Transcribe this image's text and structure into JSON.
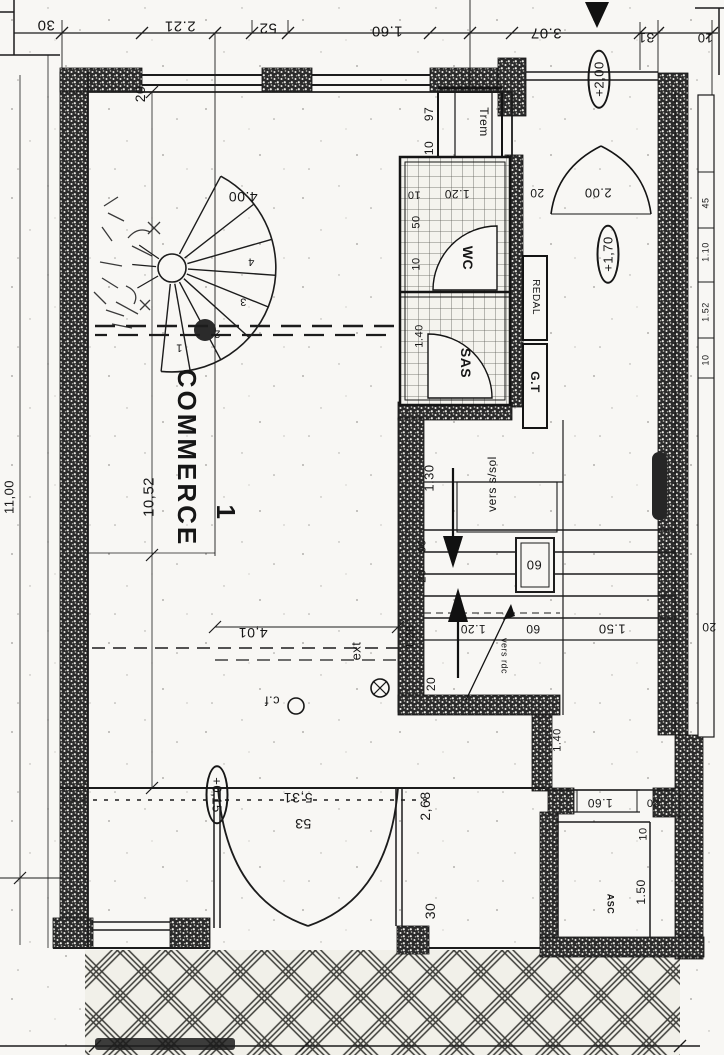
{
  "style": {
    "ink": "#1c1c1c",
    "paper": "#f8f7f4",
    "wall_hatch": "speckled-black",
    "floor_hatch": "tile-grid",
    "pavement_hatch": "diamond-lattice"
  },
  "drawing": {
    "type": "scanned-floor-plan",
    "main_room": "COMMERCE 1",
    "rooms": [
      "COMMERCE 1",
      "WC",
      "SAS",
      "ASC"
    ],
    "elevations": [
      "+2,00",
      "+1,70",
      "+0,15"
    ]
  },
  "annotations": [
    {
      "name": "dim-30-top",
      "text": "30",
      "x": 46,
      "y": 25,
      "rot": 180,
      "size": 15
    },
    {
      "name": "dim-221-top",
      "text": "2.21",
      "x": 180,
      "y": 26,
      "rot": 180,
      "size": 15
    },
    {
      "name": "dim-52-top",
      "text": "52",
      "x": 268,
      "y": 28,
      "rot": 180,
      "size": 15
    },
    {
      "name": "dim-160-top",
      "text": "1.60",
      "x": 387,
      "y": 31,
      "rot": 180,
      "size": 15
    },
    {
      "name": "dim-307-top",
      "text": "3.07",
      "x": 546,
      "y": 33,
      "rot": 180,
      "size": 15
    },
    {
      "name": "dim-31-top",
      "text": "31",
      "x": 646,
      "y": 38,
      "rot": 180,
      "size": 14
    },
    {
      "name": "dim-10-top-right",
      "text": "10",
      "x": 705,
      "y": 38,
      "rot": 180,
      "size": 13
    },
    {
      "name": "dim-1100-left",
      "text": "11,00",
      "x": 9,
      "y": 497,
      "rot": -90,
      "size": 13
    },
    {
      "name": "dim-1052-left",
      "text": "10,52",
      "x": 149,
      "y": 497,
      "rot": -90,
      "size": 15
    },
    {
      "name": "dim-20-topleft",
      "text": "20",
      "x": 140,
      "y": 94,
      "rot": -90,
      "size": 14
    },
    {
      "name": "dim-400-spiral",
      "text": "4.00",
      "x": 243,
      "y": 197,
      "rot": 180,
      "size": 14
    },
    {
      "name": "tread-num-1",
      "text": "1",
      "x": 179,
      "y": 347,
      "rot": 180,
      "size": 11
    },
    {
      "name": "tread-num-2",
      "text": "2",
      "x": 217,
      "y": 333,
      "rot": 180,
      "size": 11
    },
    {
      "name": "tread-num-3",
      "text": "3",
      "x": 243,
      "y": 301,
      "rot": 180,
      "size": 11
    },
    {
      "name": "tread-num-4",
      "text": "4",
      "x": 251,
      "y": 261,
      "rot": 180,
      "size": 11
    },
    {
      "name": "room-label-commerce",
      "text": "COMMERCE",
      "x": 187,
      "y": 458,
      "rot": 90,
      "size": 26,
      "bold": true,
      "cls": "commerce"
    },
    {
      "name": "room-label-commerce-number",
      "text": "1",
      "x": 226,
      "y": 512,
      "rot": 90,
      "size": 26,
      "bold": true
    },
    {
      "name": "dim-401",
      "text": "4,01",
      "x": 253,
      "y": 633,
      "rot": 180,
      "size": 14
    },
    {
      "name": "label-ext",
      "text": "ext",
      "x": 356,
      "y": 651,
      "rot": -90,
      "size": 13
    },
    {
      "name": "label-cf",
      "text": "c.f",
      "x": 272,
      "y": 701,
      "rot": 180,
      "size": 13
    },
    {
      "name": "dim-531",
      "text": "5,31",
      "x": 298,
      "y": 798,
      "rot": 180,
      "size": 14
    },
    {
      "name": "dim-53",
      "text": "53",
      "x": 303,
      "y": 824,
      "rot": 180,
      "size": 14
    },
    {
      "name": "dim-268",
      "text": "2,68",
      "x": 425,
      "y": 806,
      "rot": -90,
      "size": 14
    },
    {
      "name": "dim-30-bottom",
      "text": "30",
      "x": 430,
      "y": 911,
      "rot": -90,
      "size": 14
    },
    {
      "name": "elev-badge-015",
      "text": "+0,15",
      "x": 217,
      "y": 795,
      "rot": 90,
      "size": 13,
      "style": "ellipse"
    },
    {
      "name": "dim-10-wc-top",
      "text": "10",
      "x": 414,
      "y": 194,
      "rot": 180,
      "size": 11
    },
    {
      "name": "dim-120-wc",
      "text": "1.20",
      "x": 457,
      "y": 194,
      "rot": 180,
      "size": 12
    },
    {
      "name": "dim-20-hall-door",
      "text": "20",
      "x": 537,
      "y": 193,
      "rot": 180,
      "size": 12
    },
    {
      "name": "dim-200-hall-door",
      "text": "2.00",
      "x": 598,
      "y": 193,
      "rot": 180,
      "size": 13
    },
    {
      "name": "dim-50-wc",
      "text": "50",
      "x": 417,
      "y": 222,
      "rot": -90,
      "size": 11
    },
    {
      "name": "dim-10-wc-side",
      "text": "10",
      "x": 417,
      "y": 264,
      "rot": -90,
      "size": 11
    },
    {
      "name": "room-label-wc",
      "text": "WC",
      "x": 468,
      "y": 258,
      "rot": 90,
      "size": 14,
      "bold": true
    },
    {
      "name": "dim-140-sas",
      "text": "1.40",
      "x": 420,
      "y": 336,
      "rot": -90,
      "size": 11
    },
    {
      "name": "room-label-sas",
      "text": "SAS",
      "x": 466,
      "y": 363,
      "rot": 90,
      "size": 14,
      "bold": true
    },
    {
      "name": "label-tremie",
      "text": "Trem",
      "x": 484,
      "y": 122,
      "rot": 90,
      "size": 12
    },
    {
      "name": "dim-97-tremie",
      "text": "97",
      "x": 429,
      "y": 114,
      "rot": -90,
      "size": 12
    },
    {
      "name": "dim-10-tremie",
      "text": "10",
      "x": 429,
      "y": 148,
      "rot": -90,
      "size": 12
    },
    {
      "name": "label-redal",
      "text": "REDAL",
      "x": 535,
      "y": 297,
      "rot": 90,
      "size": 10
    },
    {
      "name": "label-gt",
      "text": "G.T",
      "x": 535,
      "y": 382,
      "rot": 90,
      "size": 12,
      "bold": true
    },
    {
      "name": "elev-badge-200",
      "text": "+2,00",
      "x": 599,
      "y": 79,
      "rot": -90,
      "size": 13,
      "style": "ellipse"
    },
    {
      "name": "elev-badge-170",
      "text": "+1,70",
      "x": 608,
      "y": 254,
      "rot": -90,
      "size": 13,
      "style": "ellipse"
    },
    {
      "name": "dim-45-rightwall",
      "text": "45",
      "x": 706,
      "y": 203,
      "rot": -90,
      "size": 9
    },
    {
      "name": "dim-110-rightwall",
      "text": "1.10",
      "x": 706,
      "y": 252,
      "rot": -90,
      "size": 9
    },
    {
      "name": "dim-152-rightwall",
      "text": "1.52",
      "x": 706,
      "y": 312,
      "rot": -90,
      "size": 9
    },
    {
      "name": "dim-10-rightwall",
      "text": "10",
      "x": 706,
      "y": 360,
      "rot": -90,
      "size": 9
    },
    {
      "name": "dim-130-stair",
      "text": "1.30",
      "x": 429,
      "y": 478,
      "rot": -90,
      "size": 13
    },
    {
      "name": "label-vers-ssol",
      "text": "vers s/sol",
      "x": 492,
      "y": 484,
      "rot": -90,
      "size": 12
    },
    {
      "name": "dim-90-stair",
      "text": "90",
      "x": 423,
      "y": 546,
      "rot": -90,
      "size": 11
    },
    {
      "name": "dim-20-stair",
      "text": "20",
      "x": 423,
      "y": 576,
      "rot": -90,
      "size": 11
    },
    {
      "name": "dim-60-boxed",
      "text": "60",
      "x": 534,
      "y": 565,
      "rot": 180,
      "size": 13
    },
    {
      "name": "dim-128-stair",
      "text": "1.28",
      "x": 411,
      "y": 637,
      "rot": -90,
      "size": 11
    },
    {
      "name": "dim-20-stair-bottom",
      "text": "20",
      "x": 431,
      "y": 684,
      "rot": -90,
      "size": 12
    },
    {
      "name": "dim-120-stair",
      "text": "1.20",
      "x": 473,
      "y": 629,
      "rot": 180,
      "size": 12
    },
    {
      "name": "dim-60-stair",
      "text": "60",
      "x": 533,
      "y": 629,
      "rot": 180,
      "size": 12
    },
    {
      "name": "label-vers-rdc",
      "text": "vers rdc",
      "x": 504,
      "y": 656,
      "rot": 90,
      "size": 9
    },
    {
      "name": "dim-150-stair",
      "text": "1.50",
      "x": 612,
      "y": 629,
      "rot": 180,
      "size": 13
    },
    {
      "name": "dim-20-right",
      "text": "20",
      "x": 709,
      "y": 627,
      "rot": 180,
      "size": 12
    },
    {
      "name": "dim-140-corridor",
      "text": "1.40",
      "x": 558,
      "y": 740,
      "rot": -90,
      "size": 11
    },
    {
      "name": "dim-160-asc",
      "text": "1.60",
      "x": 600,
      "y": 803,
      "rot": 180,
      "size": 12
    },
    {
      "name": "dim-20-asc",
      "text": "20",
      "x": 653,
      "y": 802,
      "rot": 180,
      "size": 11
    },
    {
      "name": "dim-10-asc",
      "text": "10",
      "x": 644,
      "y": 834,
      "rot": -90,
      "size": 11
    },
    {
      "name": "dim-150-asc",
      "text": "1.50",
      "x": 641,
      "y": 892,
      "rot": -90,
      "size": 12
    },
    {
      "name": "room-label-asc",
      "text": "ASC",
      "x": 610,
      "y": 904,
      "rot": 90,
      "size": 9,
      "bold": true
    }
  ]
}
